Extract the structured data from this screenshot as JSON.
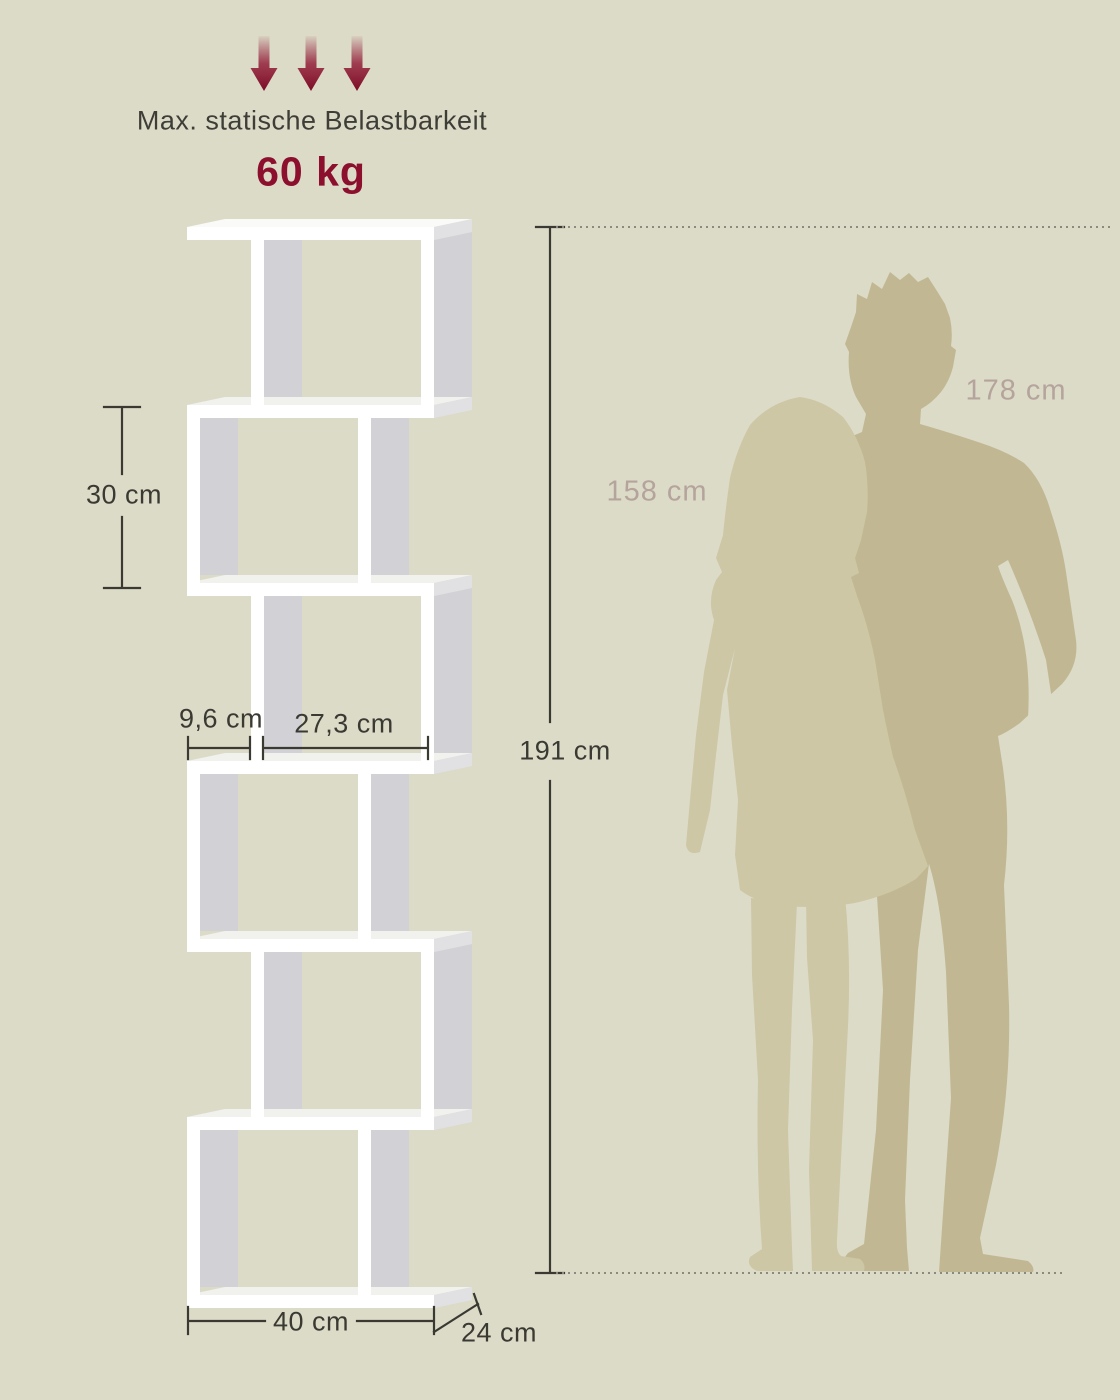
{
  "load": {
    "label": "Max. statische Belastbarkeit",
    "value": "60 kg"
  },
  "dimensions": {
    "total_height": "191 cm",
    "total_width": "40 cm",
    "depth": "24 cm",
    "tier_height": "30 cm",
    "left_section_width": "9,6 cm",
    "right_section_width": "27,3 cm"
  },
  "people": {
    "woman_height": "158 cm",
    "man_height": "178 cm"
  },
  "colors": {
    "bg": "#dcdbc8",
    "ink": "#3a3a33",
    "rose": "#b5a49c",
    "red": "#8c0f2d",
    "shelf_white": "#ffffff",
    "shelf_top": "#fafaf8",
    "shelf_floor": "#f1f1ed",
    "shelf_gray": "#d2d2d6",
    "shelf_end": "#e1e1e4",
    "man": "#c1b893",
    "woman": "#cdc7a5",
    "dotted": "#8a8a7e"
  }
}
